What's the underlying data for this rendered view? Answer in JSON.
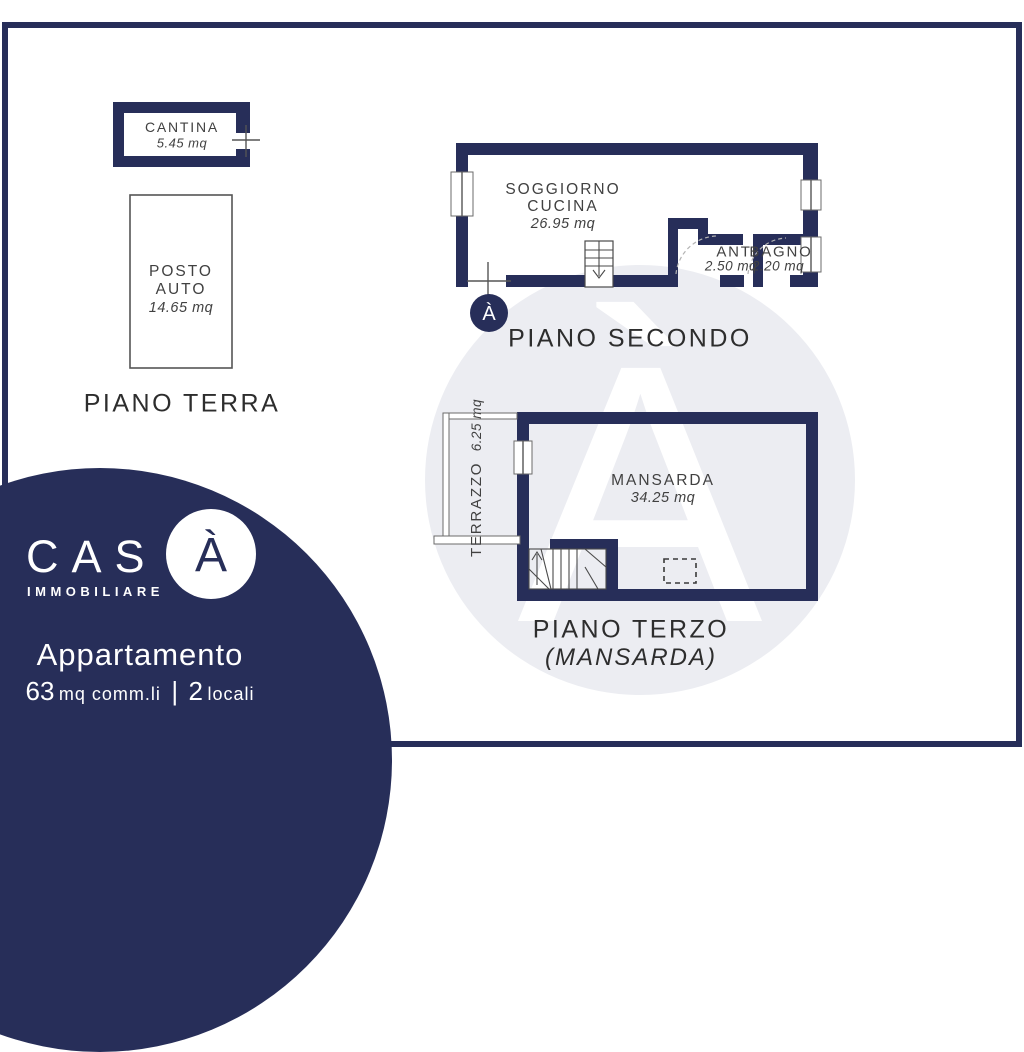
{
  "colors": {
    "navy": "#272e59",
    "line": "#555555",
    "label": "#414141",
    "title": "#2d2d2d",
    "wm": "#ecedf2"
  },
  "watermark": {
    "letter": "À"
  },
  "brand": {
    "prefix": "CAS",
    "accent_letter": "À",
    "subtitle": "IMMOBILIARE",
    "listing_type": "Appartamento",
    "area_value": "63",
    "area_unit": "mq comm.li",
    "separator": "|",
    "rooms_value": "2",
    "rooms_unit": "locali"
  },
  "floors": {
    "terra": {
      "title": "PIANO TERRA",
      "cantina": {
        "name": "CANTINA",
        "area": "5.45 mq"
      },
      "posto_auto": {
        "line1": "POSTO",
        "line2": "AUTO",
        "area": "14.65 mq"
      }
    },
    "secondo": {
      "title": "PIANO SECONDO",
      "entrance_letter": "À",
      "soggiorno": {
        "line1": "SOGGIORNO",
        "line2": "CUCINA",
        "area": "26.95 mq"
      },
      "anti": {
        "name": "ANTI",
        "area": "2.50 mq"
      },
      "bagno": {
        "name": "BAGNO",
        "area": "2.20 mq"
      }
    },
    "terzo": {
      "title": "PIANO TERZO",
      "subtitle": "(MANSARDA)",
      "mansarda": {
        "name": "MANSARDA",
        "area": "34.25 mq"
      },
      "terrazzo": {
        "name": "TERRAZZO",
        "area": "6.25 mq"
      }
    }
  }
}
